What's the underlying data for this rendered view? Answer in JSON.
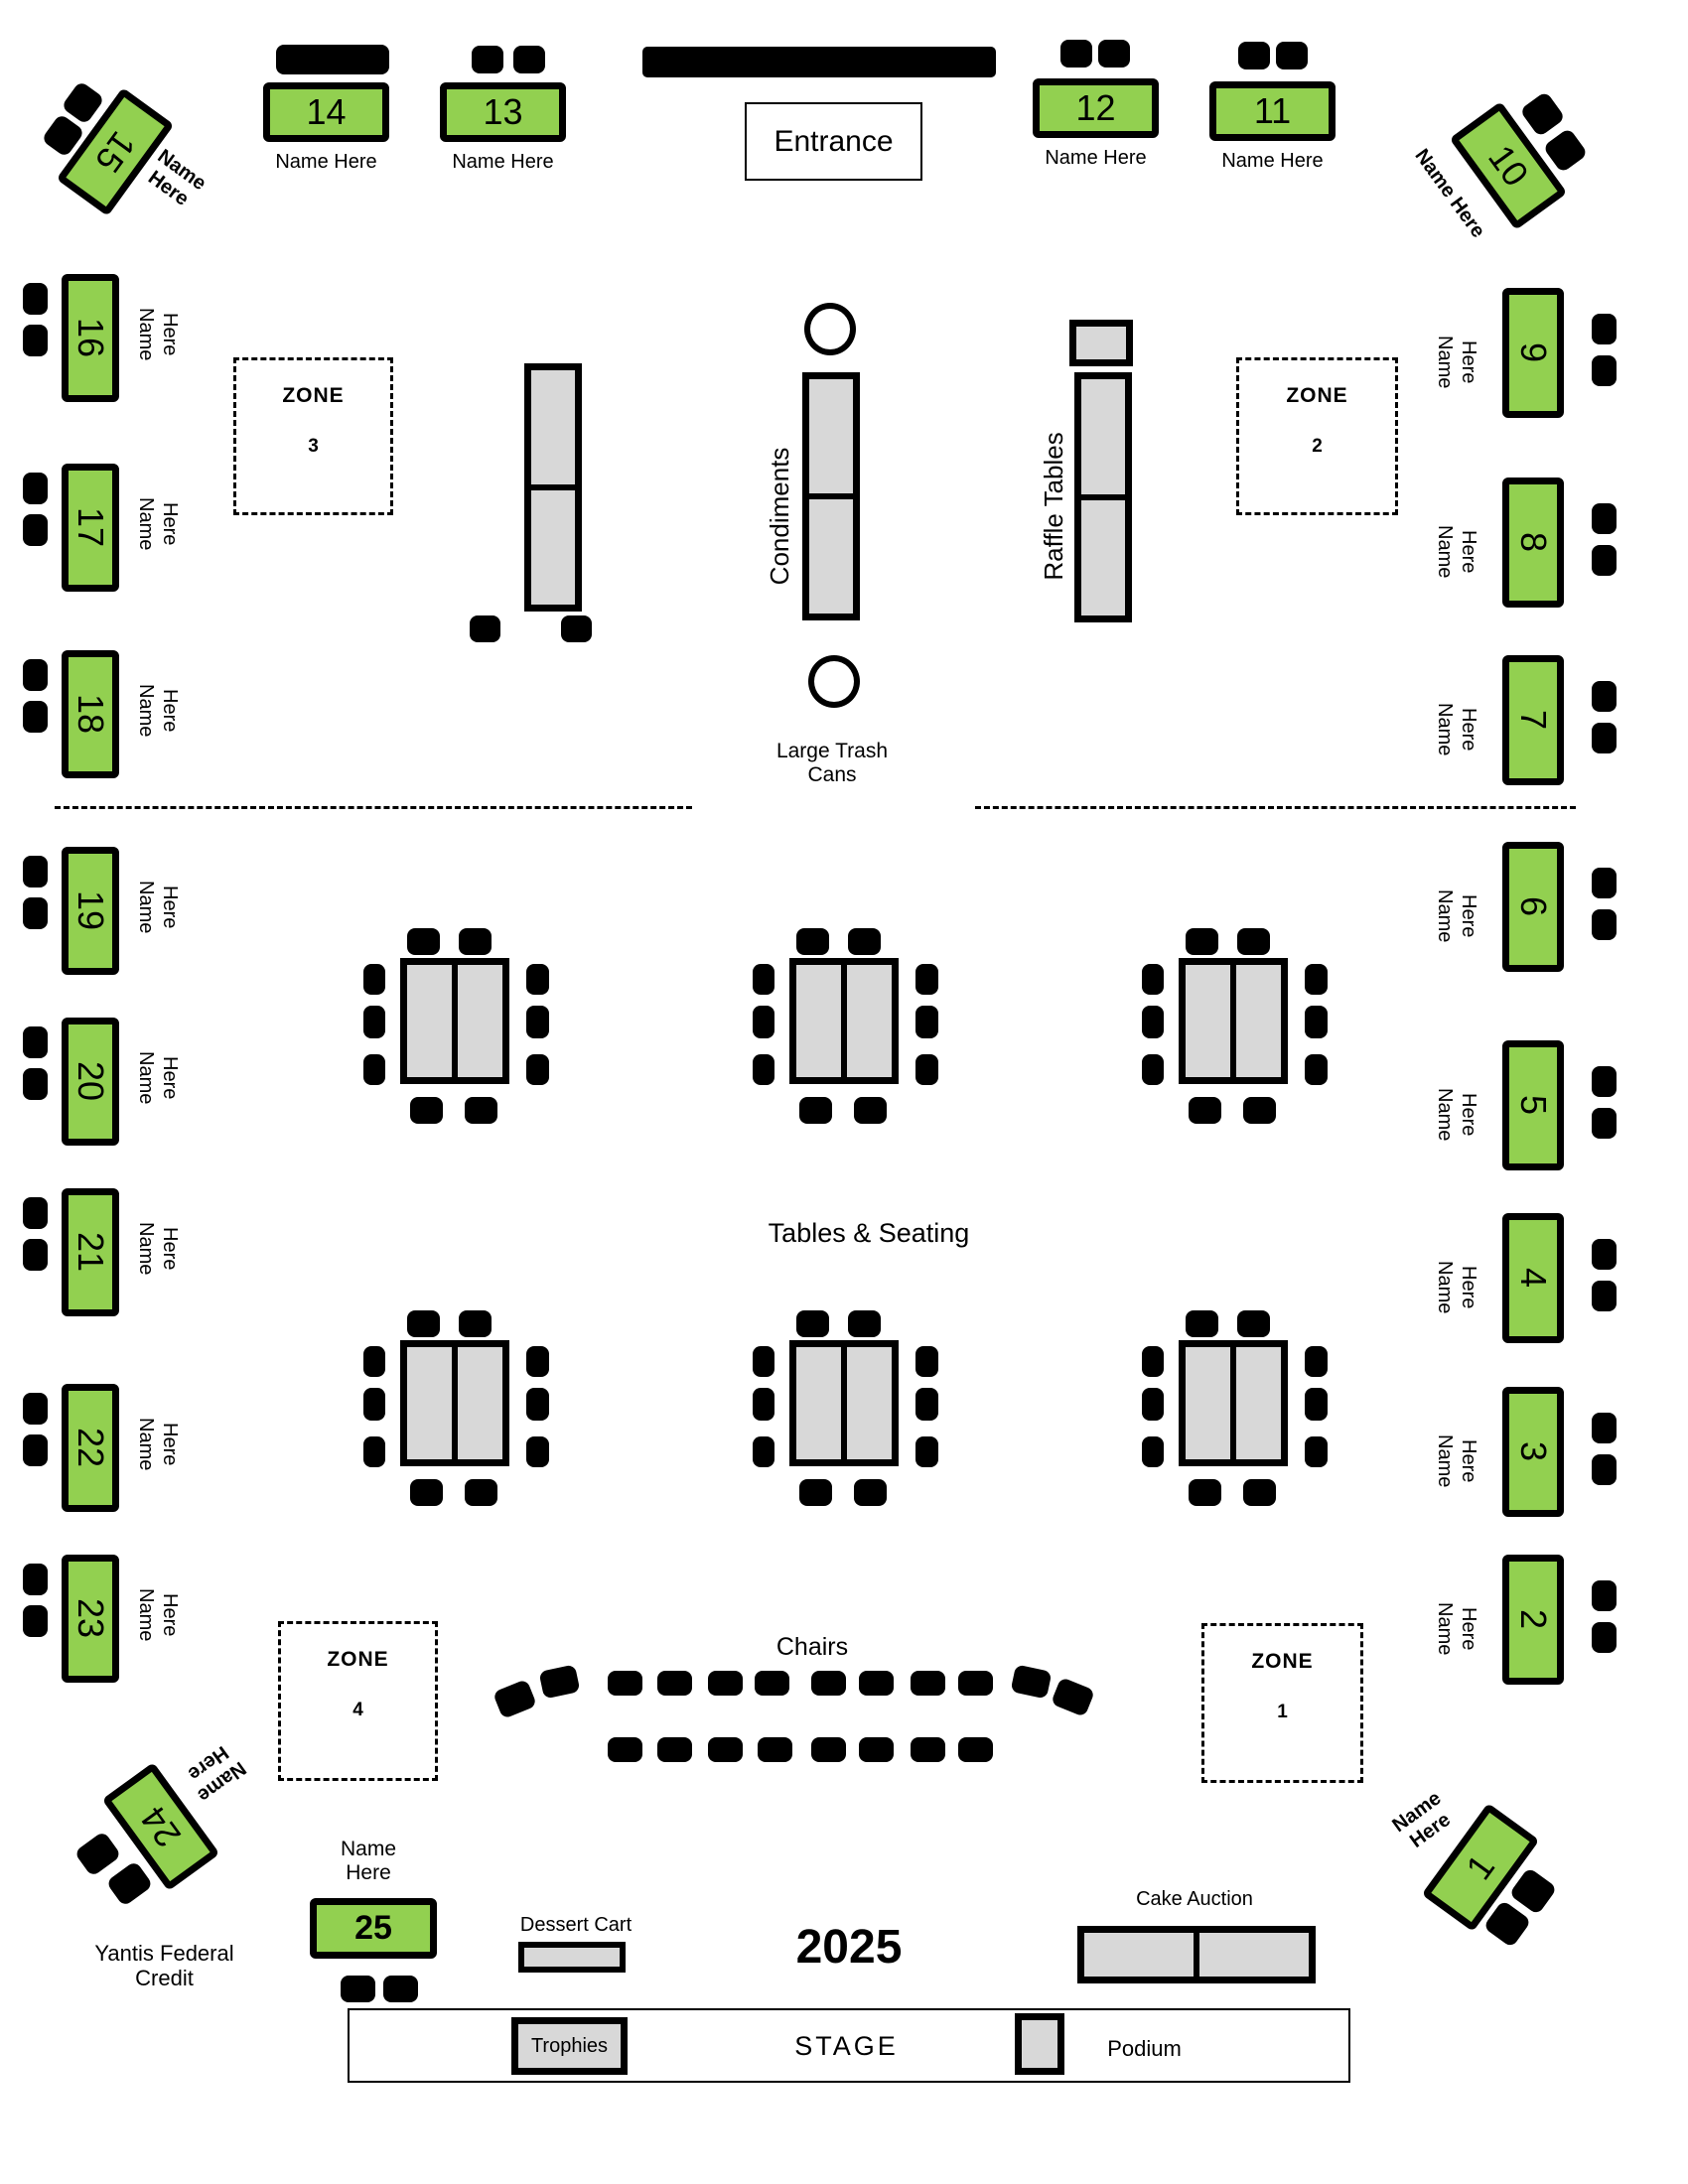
{
  "colors": {
    "table_green": "#92d050",
    "furniture_gray": "#d8d8d8",
    "chair_black": "#000000",
    "background": "#ffffff"
  },
  "labels": {
    "entrance": "Entrance",
    "condiments": "Condiments",
    "raffle_tables": "Raffle Tables",
    "large_trash_cans": "Large Trash Cans",
    "tables_seating": "Tables & Seating",
    "chairs": "Chairs",
    "yantis": "Yantis Federal Credit",
    "dessert_cart": "Dessert Cart",
    "year": "2025",
    "cake_auction": "Cake Auction",
    "stage": "STAGE",
    "trophies": "Trophies",
    "podium": "Podium"
  },
  "zones": [
    {
      "title": "ZONE",
      "number": "1"
    },
    {
      "title": "ZONE",
      "number": "2"
    },
    {
      "title": "ZONE",
      "number": "3"
    },
    {
      "title": "ZONE",
      "number": "4"
    }
  ],
  "head_tables": [
    {
      "num": "1",
      "label": "Name Here"
    },
    {
      "num": "2",
      "label": "Name Here"
    },
    {
      "num": "3",
      "label": "Name Here"
    },
    {
      "num": "4",
      "label": "Name Here"
    },
    {
      "num": "5",
      "label": "Name Here"
    },
    {
      "num": "6",
      "label": "Name Here"
    },
    {
      "num": "7",
      "label": "Name Here"
    },
    {
      "num": "8",
      "label": "Name Here"
    },
    {
      "num": "9",
      "label": "Name Here"
    },
    {
      "num": "10",
      "label": "Name Here"
    },
    {
      "num": "11",
      "label": "Name Here"
    },
    {
      "num": "12",
      "label": "Name Here"
    },
    {
      "num": "13",
      "label": "Name Here"
    },
    {
      "num": "14",
      "label": "Name Here"
    },
    {
      "num": "15",
      "label": "Name Here"
    },
    {
      "num": "16",
      "label": "Name Here"
    },
    {
      "num": "17",
      "label": "Name Here"
    },
    {
      "num": "18",
      "label": "Name Here"
    },
    {
      "num": "19",
      "label": "Name Here"
    },
    {
      "num": "20",
      "label": "Name Here"
    },
    {
      "num": "21",
      "label": "Name Here"
    },
    {
      "num": "22",
      "label": "Name Here"
    },
    {
      "num": "23",
      "label": "Name Here"
    },
    {
      "num": "24",
      "label": "Name Here"
    },
    {
      "num": "25",
      "label": "Name Here"
    }
  ]
}
